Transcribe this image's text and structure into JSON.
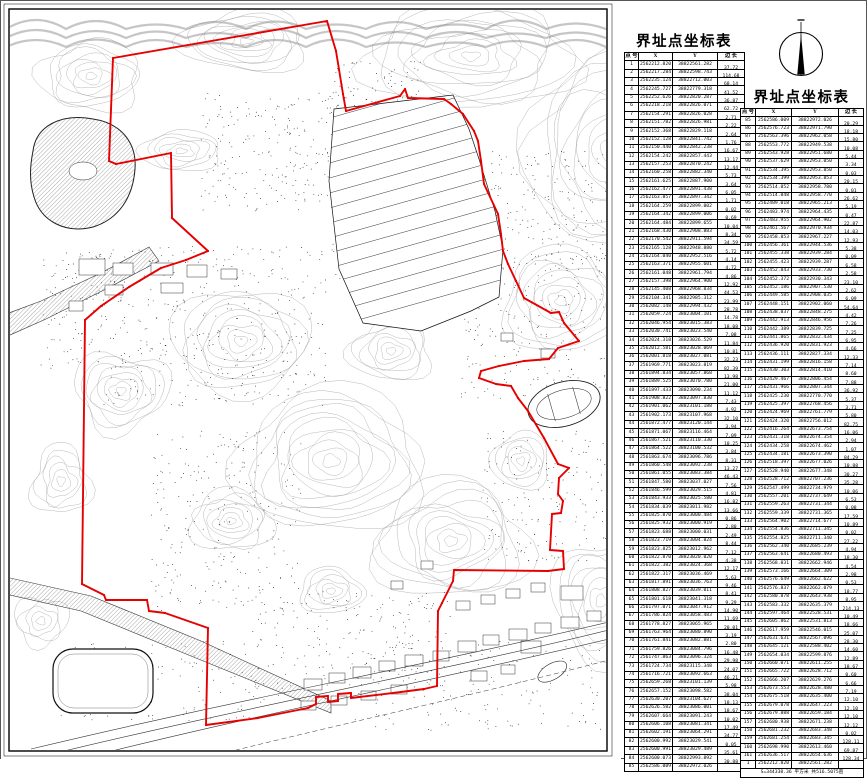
{
  "map": {
    "boundary_color": "#e60000",
    "contour_color": "#9a9a9a",
    "boundary_px": [
      [
        326,
        20
      ],
      [
        112,
        57
      ],
      [
        108,
        160
      ],
      [
        115,
        163
      ],
      [
        170,
        152
      ],
      [
        171,
        217
      ],
      [
        207,
        250
      ],
      [
        185,
        259
      ],
      [
        160,
        267
      ],
      [
        128,
        286
      ],
      [
        100,
        305
      ],
      [
        84,
        319
      ],
      [
        81,
        583
      ],
      [
        103,
        594
      ],
      [
        105,
        599
      ],
      [
        146,
        599
      ],
      [
        148,
        610
      ],
      [
        164,
        612
      ],
      [
        207,
        627
      ],
      [
        205,
        724
      ],
      [
        257,
        717
      ],
      [
        307,
        707
      ],
      [
        315,
        703
      ],
      [
        315,
        696
      ],
      [
        327,
        695
      ],
      [
        327,
        701
      ],
      [
        337,
        700
      ],
      [
        337,
        693
      ],
      [
        350,
        692
      ],
      [
        350,
        697
      ],
      [
        400,
        691
      ],
      [
        423,
        688
      ],
      [
        436,
        685
      ],
      [
        437,
        610
      ],
      [
        441,
        602
      ],
      [
        452,
        580
      ],
      [
        453,
        569
      ],
      [
        547,
        570
      ],
      [
        563,
        568
      ],
      [
        562,
        550
      ],
      [
        549,
        549
      ],
      [
        551,
        513
      ],
      [
        560,
        512
      ],
      [
        562,
        500
      ],
      [
        557,
        493
      ],
      [
        558,
        477
      ],
      [
        568,
        467
      ],
      [
        557,
        463
      ],
      [
        543,
        437
      ],
      [
        527,
        410
      ],
      [
        517,
        397
      ],
      [
        510,
        385
      ],
      [
        495,
        383
      ],
      [
        478,
        377
      ],
      [
        480,
        370
      ],
      [
        498,
        365
      ],
      [
        523,
        360
      ],
      [
        548,
        358
      ],
      [
        557,
        347
      ],
      [
        578,
        340
      ],
      [
        563,
        322
      ],
      [
        558,
        311
      ],
      [
        550,
        312
      ],
      [
        523,
        297
      ],
      [
        515,
        280
      ],
      [
        507,
        263
      ],
      [
        502,
        250
      ],
      [
        500,
        233
      ],
      [
        497,
        213
      ],
      [
        483,
        183
      ],
      [
        480,
        160
      ],
      [
        477,
        140
      ],
      [
        473,
        130
      ],
      [
        462,
        113
      ],
      [
        450,
        103
      ],
      [
        443,
        98
      ],
      [
        407,
        97
      ],
      [
        404,
        88
      ],
      [
        399,
        95
      ],
      [
        345,
        110
      ],
      [
        342,
        93
      ],
      [
        335,
        50
      ]
    ]
  },
  "table1": {
    "name": "boundary-point-table-1",
    "title": "界址点坐标表",
    "columns": [
      "点 号",
      "X",
      "Y",
      "边 长"
    ],
    "rows": [
      [
        1,
        "2562212.820",
        "38822561.282"
      ],
      [
        2,
        "2562217.284",
        "38822598.743"
      ],
      [
        3,
        "2562235.124",
        "38822712.003"
      ],
      [
        4,
        "2562245.727",
        "38822779.318"
      ],
      [
        5,
        "2562252.626",
        "38822820.287"
      ],
      [
        6,
        "2562218.218",
        "38822826.071"
      ],
      [
        7,
        "2562154.291",
        "38822826.028"
      ],
      [
        8,
        "2562151.782",
        "38822826.981"
      ],
      [
        9,
        "2562152.368",
        "38822829.118"
      ],
      [
        10,
        "2562152.128",
        "38822841.742"
      ],
      [
        11,
        "2562150.440",
        "38822842.238"
      ],
      [
        12,
        "2562154.242",
        "38822857.443"
      ],
      [
        13,
        "2562157.253",
        "38822870.242"
      ],
      [
        14,
        "2562160.258",
        "38822882.340"
      ],
      [
        15,
        "2562161.625",
        "38822887.900"
      ],
      [
        16,
        "2562162.477",
        "38822891.438"
      ],
      [
        17,
        "2562163.857",
        "38822897.342"
      ],
      [
        18,
        "2562164.259",
        "38822899.002"
      ],
      [
        19,
        "2562164.342",
        "38822899.006"
      ],
      [
        20,
        "2562164.484",
        "38822899.655"
      ],
      [
        21,
        "2562168.430",
        "38822908.883"
      ],
      [
        22,
        "2562170.542",
        "38822911.594"
      ],
      [
        23,
        "2562165.128",
        "38822948.880"
      ],
      [
        24,
        "2562164.040",
        "38822952.516"
      ],
      [
        25,
        "2562163.371",
        "38822955.601"
      ],
      [
        26,
        "2562161.048",
        "38822961.794"
      ],
      [
        27,
        "2562157.398",
        "38822964.900"
      ],
      [
        28,
        "2562145.408",
        "38822968.834"
      ],
      [
        29,
        "2562104.341",
        "38822985.312"
      ],
      [
        30,
        "2562082.148",
        "38822994.432"
      ],
      [
        31,
        "2562059.724",
        "38823004.101"
      ],
      [
        32,
        "2562046.954",
        "38823015.383"
      ],
      [
        33,
        "2562030.741",
        "38823023.540"
      ],
      [
        34,
        "2562024.318",
        "38823026.529"
      ],
      [
        35,
        "2562012.581",
        "38823028.069"
      ],
      [
        36,
        "2562001.818",
        "38823027.081"
      ],
      [
        37,
        "2561969.771",
        "38823023.819"
      ],
      [
        38,
        "2561894.834",
        "38823057.868"
      ],
      [
        39,
        "2561889.525",
        "38823070.780"
      ],
      [
        40,
        "2561897.433",
        "38823090.234"
      ],
      [
        41,
        "2561908.822",
        "38823097.830"
      ],
      [
        42,
        "2561901.062",
        "38823101.188"
      ],
      [
        43,
        "2561902.173",
        "38823107.968"
      ],
      [
        44,
        "2561872.477",
        "38823120.144"
      ],
      [
        45,
        "2561871.067",
        "38823116.464"
      ],
      [
        46,
        "2561867.521",
        "38823110.330"
      ],
      [
        47,
        "2561864.522",
        "38823100.532"
      ],
      [
        48,
        "2561863.674",
        "38823096.786"
      ],
      [
        49,
        "2561860.548",
        "38823092.238"
      ],
      [
        50,
        "2561861.055",
        "38823083.384"
      ],
      [
        51,
        "2561847.580",
        "38823037.027"
      ],
      [
        52,
        "2561846.599",
        "38823029.515"
      ],
      [
        53,
        "2561843.933",
        "38823025.580"
      ],
      [
        54,
        "2561834.039",
        "38823011.982"
      ],
      [
        55,
        "2561825.870",
        "38823000.484"
      ],
      [
        56,
        "2561825.932",
        "38823000.919"
      ],
      [
        57,
        "2561823.688",
        "38823000.031"
      ],
      [
        58,
        "2561823.719",
        "38823004.824"
      ],
      [
        59,
        "2561823.825",
        "38823012.962"
      ],
      [
        60,
        "2561822.870",
        "38823020.020"
      ],
      [
        61,
        "2561822.382",
        "38823024.368"
      ],
      [
        62,
        "2561822.317",
        "38823036.469"
      ],
      [
        63,
        "2561817.891",
        "38823036.763"
      ],
      [
        64,
        "2561808.827",
        "38823039.011"
      ],
      [
        65,
        "2561801.618",
        "38823041.318"
      ],
      [
        66,
        "2561797.071",
        "38823047.912"
      ],
      [
        67,
        "2561786.824",
        "38823058.483"
      ],
      [
        68,
        "2561778.827",
        "38823065.965"
      ],
      [
        69,
        "2561763.964",
        "38823080.890"
      ],
      [
        70,
        "2561761.841",
        "38823082.881"
      ],
      [
        71,
        "2561759.826",
        "38823084.796"
      ],
      [
        72,
        "2561747.863",
        "38823096.324"
      ],
      [
        73,
        "2561724.734",
        "38823115.348"
      ],
      [
        74,
        "2561716.721",
        "38823092.663"
      ],
      [
        75,
        "2562659.268",
        "38823101.139"
      ],
      [
        76,
        "2562657.152",
        "38823098.582"
      ],
      [
        77,
        "2562630.207",
        "38823104.627"
      ],
      [
        78,
        "2562626.582",
        "38823086.001"
      ],
      [
        79,
        "2562607.664",
        "38823091.243"
      ],
      [
        80,
        "2562606.108",
        "38823081.341"
      ],
      [
        81,
        "2562602.191",
        "38823064.291"
      ],
      [
        82,
        "2562600.992",
        "38823029.541"
      ],
      [
        83,
        "2562600.991",
        "38823029.489"
      ],
      [
        84,
        "2562600.073",
        "38822993.892"
      ],
      [
        85,
        "2562586.009",
        "38822972.026"
      ]
    ],
    "edges": [
      "37.72",
      "114.68",
      "68.14",
      "41.52",
      "36.87",
      "62.72",
      "2.71",
      "2.22",
      "2.64",
      "1.76",
      "16.67",
      "13.17",
      "12.44",
      "5.73",
      "3.64",
      "6.05",
      "1.71",
      "0.02",
      "0.69",
      "10.04",
      "8.34",
      "34.59",
      "5.72",
      "4.14",
      "4.72",
      "4.86",
      "12.92",
      "44.53",
      "23.99",
      "28.78",
      "14.78",
      "18.08",
      "7.08",
      "11.84",
      "10.81",
      "32.23",
      "82.39",
      "13.98",
      "21.00",
      "11.12",
      "7.43",
      "4.92",
      "32.10",
      "3.94",
      "7.09",
      "10.25",
      "3.84",
      "8.31",
      "13.27",
      "46.43",
      "7.56",
      "4.81",
      "16.82",
      "13.66",
      "0.86",
      "2.80",
      "2.49",
      "8.44",
      "7.12",
      "4.38",
      "12.17",
      "5.63",
      "9.46",
      "8.41",
      "9.29",
      "14.90",
      "11.69",
      "20.01",
      "3.19",
      "2.80",
      "16.48",
      "29.98",
      "24.07",
      "46.21",
      "5.98",
      "38.04",
      "18.13",
      "18.67",
      "10.02",
      "17.49",
      "34.77",
      "0.05",
      "35.61",
      "30.88"
    ]
  },
  "table2": {
    "name": "boundary-point-table-2",
    "title": "界址点坐标表",
    "columns": [
      "点 号",
      "X",
      "Y",
      "边 长"
    ],
    "rows": [
      [
        85,
        "2562586.009",
        "38822972.026"
      ],
      [
        86,
        "2562576.723",
        "38822971.790"
      ],
      [
        87,
        "2562563.396",
        "38822962.058"
      ],
      [
        88,
        "2562553.772",
        "38822949.538"
      ],
      [
        89,
        "2562543.928",
        "38822951.680"
      ],
      [
        90,
        "2562537.629",
        "38822953.050"
      ],
      [
        91,
        "2562534.395",
        "38822953.850"
      ],
      [
        92,
        "2562534.399",
        "38822953.853"
      ],
      [
        93,
        "2562514.852",
        "38822958.780"
      ],
      [
        94,
        "2562514.848",
        "38822958.770"
      ],
      [
        95,
        "2562489.018",
        "38822965.213"
      ],
      [
        96,
        "2562483.974",
        "38822964.435"
      ],
      [
        97,
        "2562483.955",
        "38822964.902"
      ],
      [
        98,
        "2562461.567",
        "38822970.934"
      ],
      [
        99,
        "2562458.853",
        "38822967.227"
      ],
      [
        100,
        "2562456.361",
        "38822944.536"
      ],
      [
        101,
        "2562455.338",
        "38822939.284"
      ],
      [
        102,
        "2562455.423",
        "38822939.287"
      ],
      [
        103,
        "2562452.843",
        "38822933.730"
      ],
      [
        104,
        "2562452.372",
        "38822930.343"
      ],
      [
        105,
        "2562452.186",
        "38822907.530"
      ],
      [
        106,
        "2562449.585",
        "38822908.035"
      ],
      [
        107,
        "2562448.151",
        "38822902.060"
      ],
      [
        108,
        "2562438.837",
        "38822848.275"
      ],
      [
        109,
        "2562442.913",
        "38822846.956"
      ],
      [
        110,
        "2562442.389",
        "38822839.725"
      ],
      [
        111,
        "2562441.865",
        "38822832.434"
      ],
      [
        112,
        "2562436.920",
        "38822831.923"
      ],
      [
        113,
        "2562436.111",
        "38822827.334"
      ],
      [
        114,
        "2562431.199",
        "38822816.158"
      ],
      [
        115,
        "2562430.303",
        "38822814.410"
      ],
      [
        116,
        "2562429.467",
        "38822806.454"
      ],
      [
        117,
        "2562431.966",
        "38822807.344"
      ],
      [
        118,
        "2562425.230",
        "38822770.770"
      ],
      [
        119,
        "2562425.397",
        "38822768.456"
      ],
      [
        120,
        "2562424.969",
        "38822761.779"
      ],
      [
        121,
        "2562424.320",
        "38822756.012"
      ],
      [
        122,
        "2562416.264",
        "38822673.754"
      ],
      [
        123,
        "2562431.318",
        "38822674.354"
      ],
      [
        124,
        "2562434.258",
        "38822674.462"
      ],
      [
        125,
        "2562434.181",
        "38822673.390"
      ],
      [
        126,
        "2562518.397",
        "38822677.026"
      ],
      [
        127,
        "2562528.940",
        "38822677.348"
      ],
      [
        128,
        "2562528.712",
        "38822707.236"
      ],
      [
        129,
        "2562547.499",
        "38822734.979"
      ],
      [
        130,
        "2562557.201",
        "38822737.649"
      ],
      [
        131,
        "2562559.263",
        "38822731.344"
      ],
      [
        132,
        "2562559.339",
        "38822731.365"
      ],
      [
        133,
        "2562564.902",
        "38822714.677"
      ],
      [
        134,
        "2562554.836",
        "38822711.345"
      ],
      [
        135,
        "2562554.825",
        "38822711.340"
      ],
      [
        136,
        "2562562.340",
        "38822685.239"
      ],
      [
        137,
        "2562563.641",
        "38822680.493"
      ],
      [
        138,
        "2562568.831",
        "38822662.946"
      ],
      [
        139,
        "2562573.166",
        "38822664.309"
      ],
      [
        140,
        "2562576.649",
        "38822662.622"
      ],
      [
        141,
        "2562576.837",
        "38822662.079"
      ],
      [
        142,
        "2562580.878",
        "38822643.938"
      ],
      [
        143,
        "2562583.332",
        "38822635.379"
      ],
      [
        144,
        "2562597.464",
        "38822528.531"
      ],
      [
        145,
        "2562605.862",
        "38822531.813"
      ],
      [
        146,
        "2562617.959",
        "38822546.015"
      ],
      [
        147,
        "2562631.631",
        "38822567.096"
      ],
      [
        148,
        "2562645.121",
        "38822588.402"
      ],
      [
        149,
        "2562654.034",
        "38822599.876"
      ],
      [
        150,
        "2562660.071",
        "38822611.255"
      ],
      [
        151,
        "2562665.722",
        "38822628.712"
      ],
      [
        152,
        "2562666.207",
        "38822629.276"
      ],
      [
        153,
        "2562673.553",
        "38822628.480"
      ],
      [
        154,
        "2562675.518",
        "38822635.400"
      ],
      [
        155,
        "2562679.078",
        "38822647.223"
      ],
      [
        156,
        "2562679.888",
        "38822659.184"
      ],
      [
        157,
        "2562680.938",
        "38822671.238"
      ],
      [
        158,
        "2562681.232",
        "38822683.348"
      ],
      [
        159,
        "2562681.254",
        "38822683.345"
      ],
      [
        160,
        "2562698.990",
        "38822613.460"
      ],
      [
        161,
        "2562636.517",
        "38822654.636"
      ],
      [
        1,
        "2562212.820",
        "38822561.282"
      ]
    ],
    "edges": [
      "20.29",
      "18.18",
      "15.80",
      "10.08",
      "5.44",
      "3.34",
      "0.03",
      "20.15",
      "0.01",
      "26.62",
      "5.19",
      "0.47",
      "22.87",
      "14.03",
      "12.93",
      "5.38",
      "0.09",
      "6.58",
      "2.58",
      "23.10",
      "2.62",
      "6.09",
      "54.64",
      "4.42",
      "7.26",
      "7.25",
      "6.95",
      "4.66",
      "12.33",
      "7.14",
      "8.60",
      "7.88",
      "36.92",
      "5.37",
      "3.71",
      "5.80",
      "82.75",
      "16.06",
      "2.94",
      "1.07",
      "84.29",
      "10.88",
      "30.27",
      "35.28",
      "10.06",
      "6.53",
      "0.08",
      "17.59",
      "10.89",
      "0.02",
      "27.22",
      "4.94",
      "18.30",
      "4.54",
      "2.98",
      "0.53",
      "18.77",
      "8.95",
      "214.13",
      "10.49",
      "18.66",
      "25.07",
      "28.30",
      "14.60",
      "12.89",
      "18.67",
      "0.60",
      "6.66",
      "7.19",
      "12.10",
      "12.10",
      "12.10",
      "12.12",
      "0.02",
      "128.11",
      "69.87",
      "128.34"
    ],
    "summary": "S=344338.36 平方米  共516.5075亩"
  }
}
